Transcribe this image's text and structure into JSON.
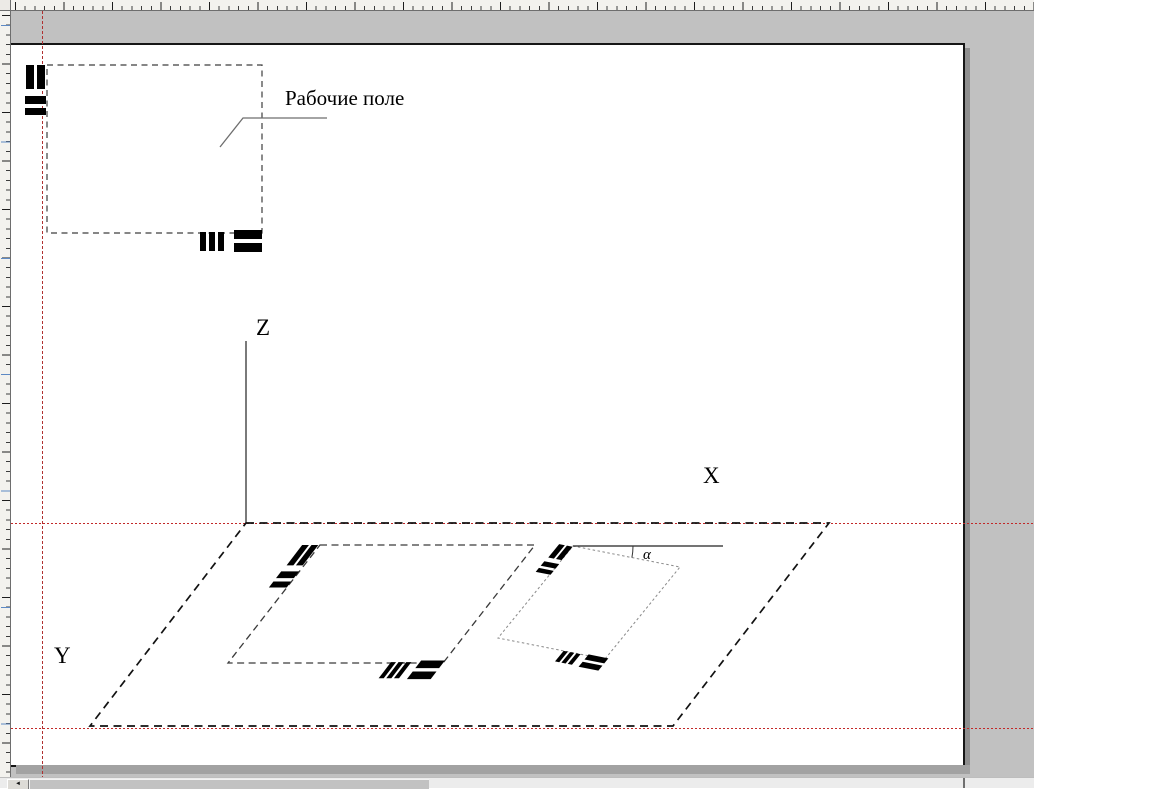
{
  "drawing": {
    "working_field_label": "Рабочие поле",
    "axis_labels": {
      "x": "X",
      "y": "Y",
      "z": "Z"
    },
    "angle_label": "α"
  },
  "guides": {
    "color": "#c02828",
    "vertical_x": 42,
    "horizontal_y": [
      523,
      728
    ]
  },
  "colors": {
    "canvas_background": "#c1c1c1",
    "page": "#ffffff",
    "registration_mark": "#000000",
    "dashed_outline": "#3a3a3a"
  },
  "scrollbar": {
    "left_arrow_icon": "◄"
  }
}
